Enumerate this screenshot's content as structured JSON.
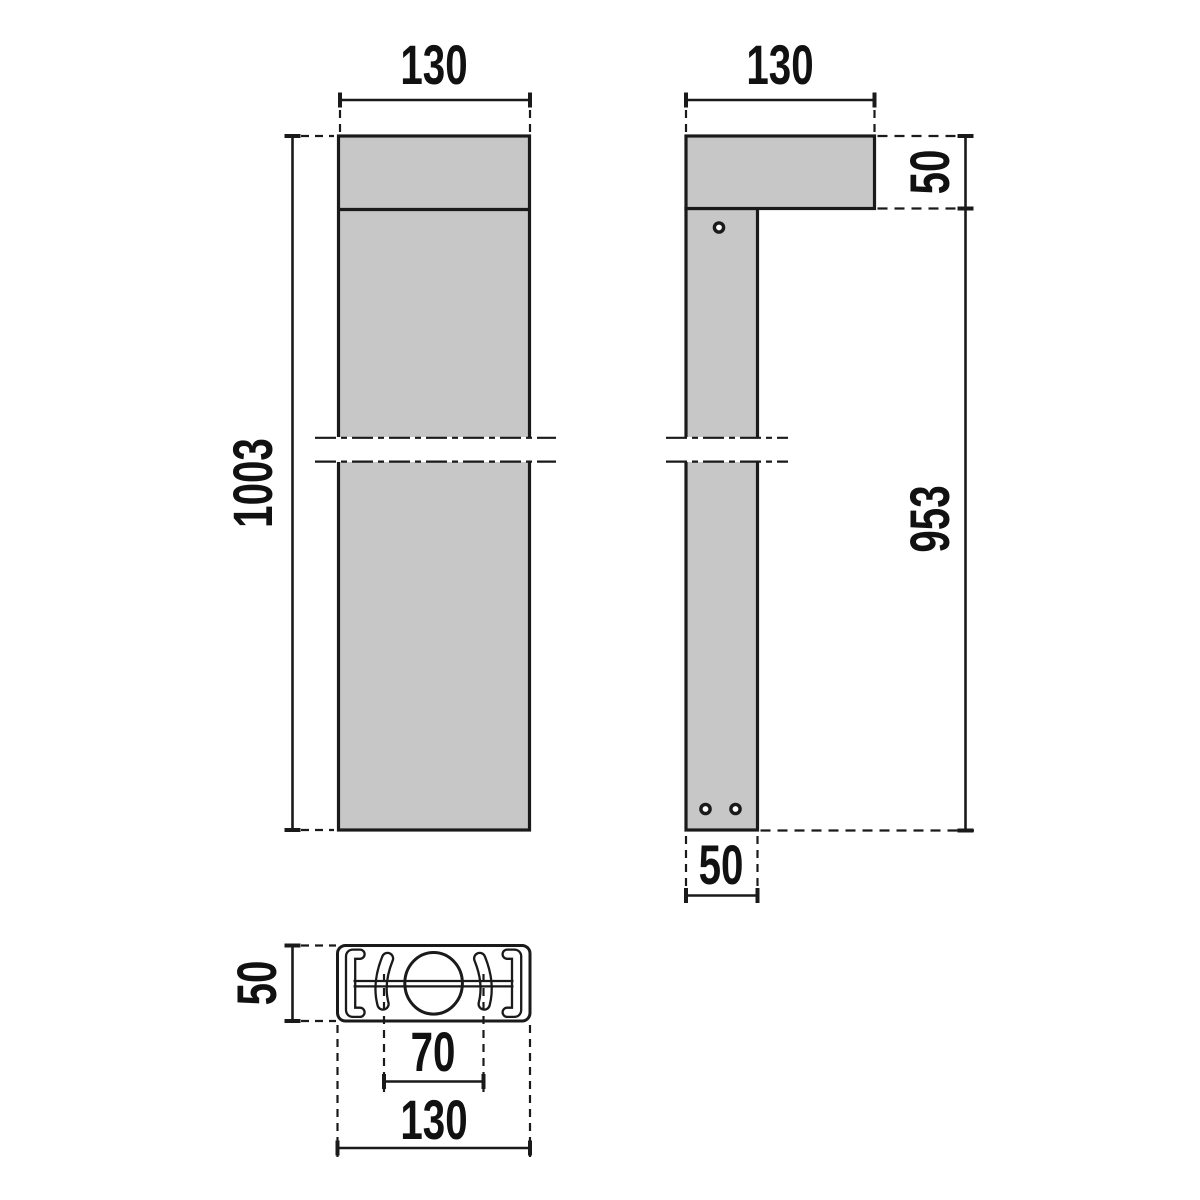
{
  "colors": {
    "body_fill": "#c7c7c7",
    "line": "#1a1a1a",
    "text": "#111111",
    "background": "#ffffff"
  },
  "views": {
    "front": {
      "width_label": "130",
      "height_label": "1003"
    },
    "side": {
      "width_label": "130",
      "head_height_label": "50",
      "post_height_label": "953",
      "post_width_label": "50"
    },
    "top": {
      "depth_label": "50",
      "slot_spacing_label": "70",
      "width_label": "130"
    }
  }
}
